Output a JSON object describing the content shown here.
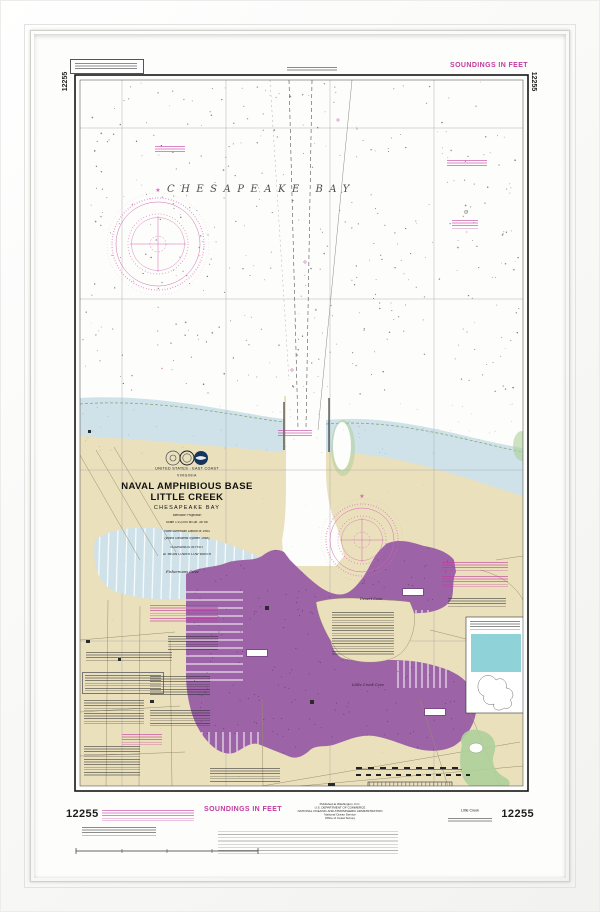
{
  "chart": {
    "number": "12255",
    "soundings_top": "SOUNDINGS IN FEET",
    "soundings_bottom": "SOUNDINGS IN FEET",
    "bay_label": "CHESAPEAKE BAY",
    "title_block": {
      "country": "UNITED STATES - EAST COAST",
      "state": "VIRGINIA",
      "title1": "NAVAL AMPHIBIOUS BASE",
      "title2": "LITTLE CREEK",
      "subtitle": "CHESAPEAKE BAY",
      "proj1": "Mercator Projection",
      "proj2": "Scale 1:10,000 at Lat. 36°56'",
      "datum1": "North American Datum of 1983",
      "datum2": "(World Geodetic System 1984)",
      "sound1": "SOUNDINGS IN FEET",
      "sound2": "AT MEAN LOWER LOW WATER"
    },
    "place_labels": {
      "fishermans_cove": "Fishermans Cove",
      "desert_cove": "Desert Cove",
      "little_creek_cove": "Little Creek Cove"
    },
    "bottom": {
      "publisher": [
        "Published at Washington, D.C.",
        "U.S. DEPARTMENT OF COMMERCE",
        "NATIONAL OCEANIC AND ATMOSPHERIC ADMINISTRATION",
        "National Ocean Service",
        "Office of Coast Survey"
      ],
      "edition_label": "Little Creek"
    }
  },
  "colors": {
    "magenta": "#c13a9e",
    "rose_magenta": "#d06cb4",
    "purple_area": "#9c63a6",
    "land_tan": "#eae0bc",
    "shallow_blue": "#cfe2e9",
    "inset_teal": "#8fd2d8",
    "marsh_green": "#aed09a"
  }
}
